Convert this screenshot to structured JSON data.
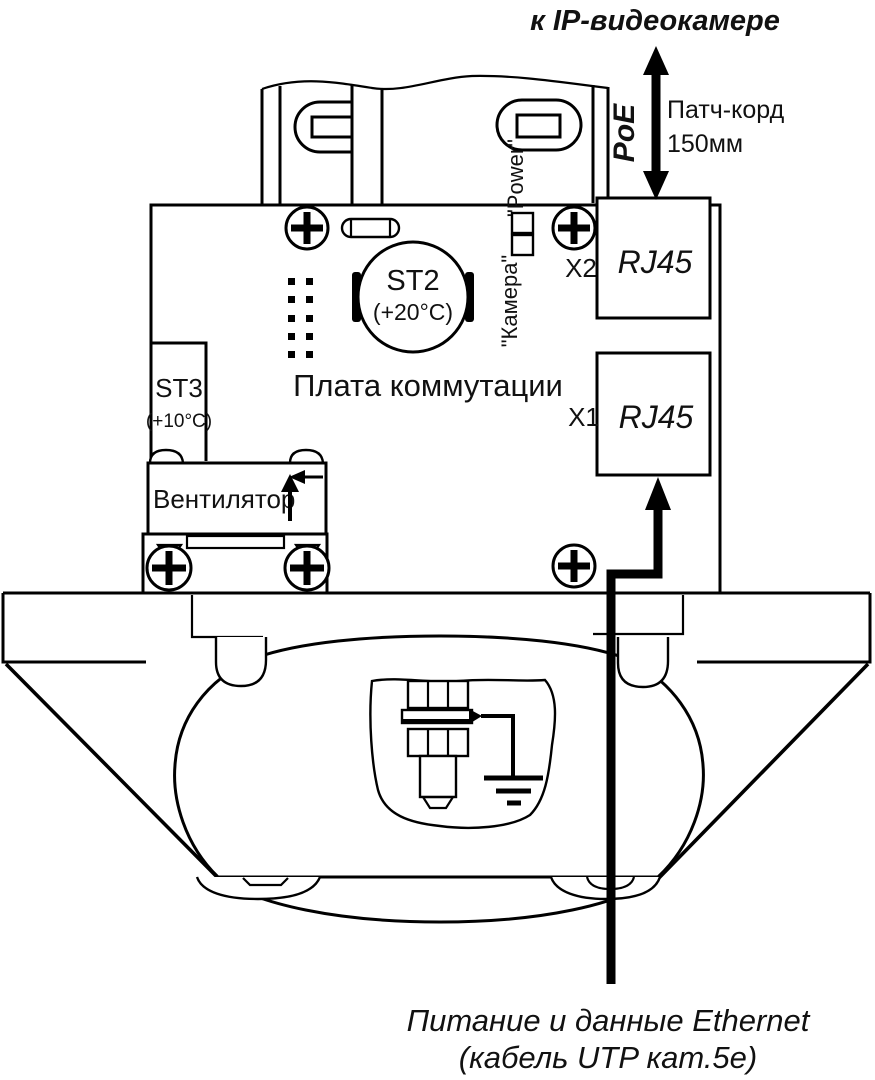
{
  "diagram": {
    "top_label": "к IP-видеокамере",
    "poe_label": "PoE",
    "patch_cord_line1": "Патч-корд",
    "patch_cord_line2": "150мм",
    "power_led_label": "\"Power\"",
    "camera_led_label": "\"Камера\"",
    "connector_x2": "X2",
    "connector_x1": "X1",
    "rj45_x2_label": "RJ45",
    "rj45_x1_label": "RJ45",
    "sensor_st2": "ST2",
    "sensor_st2_temp": "(+20°C)",
    "sensor_st3": "ST3",
    "sensor_st3_temp": "(+10°C)",
    "board_label": "Плата коммутации",
    "fan_label": "Вентилятор",
    "bottom_label_line1": "Питание и данные Ethernet",
    "bottom_label_line2": "(кабель UTP кат.5е)",
    "colors": {
      "line": "#000000",
      "text": "#111111",
      "background": "#ffffff"
    }
  }
}
